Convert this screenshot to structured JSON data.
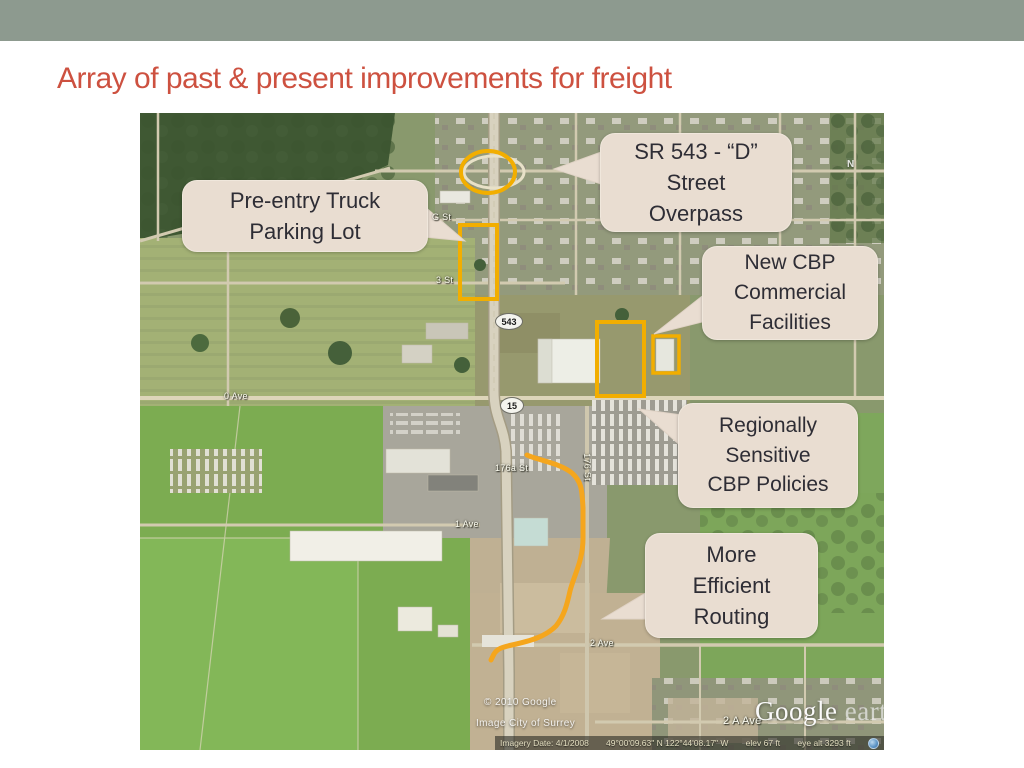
{
  "slide": {
    "title": "Array of past & present improvements for freight"
  },
  "theme": {
    "header_bar_color": "#8d9a8f",
    "title_color": "#cd5140",
    "callout_bg": "#e9ddd1",
    "callout_text": "#2e2d35",
    "highlight_yellow": "#f2ae00",
    "route_orange": "#f5a61d"
  },
  "map": {
    "callouts": [
      {
        "id": "sr543-d-street-overpass",
        "text": "SR 543 - “D”\nStreet\nOverpass"
      },
      {
        "id": "pre-entry-truck-parking",
        "text": "Pre-entry Truck\nParking Lot"
      },
      {
        "id": "new-cbp-commercial-facilities",
        "text": "New CBP\nCommercial\nFacilities"
      },
      {
        "id": "regionally-sensitive-cbp-policies",
        "text": "Regionally\nSensitive\nCBP Policies"
      },
      {
        "id": "more-efficient-routing",
        "text": "More\nEfficient\nRouting"
      }
    ],
    "labels": {
      "g_st": "G St",
      "st3": "3 St",
      "hwy543": "543",
      "hwy15": "15",
      "ave0": "0 Ave",
      "st176a": "176a St",
      "st176": "176 St",
      "ave1": "1 Ave",
      "ave2": "2 Ave",
      "ave2a": "2 A Ave",
      "compass": "N"
    },
    "credits": {
      "line1": "© 2010 Google",
      "line2": "Image City of Surrey"
    },
    "watermark": {
      "brand": "Google",
      "product": "earth"
    },
    "statusbar": {
      "imagery_date": "Imagery Date: 4/1/2008",
      "coordinates": "49°00'09.63\" N   122°44'08.17\" W",
      "elevation": "elev    67 ft",
      "eye_altitude": "eye alt   3293 ft"
    }
  }
}
